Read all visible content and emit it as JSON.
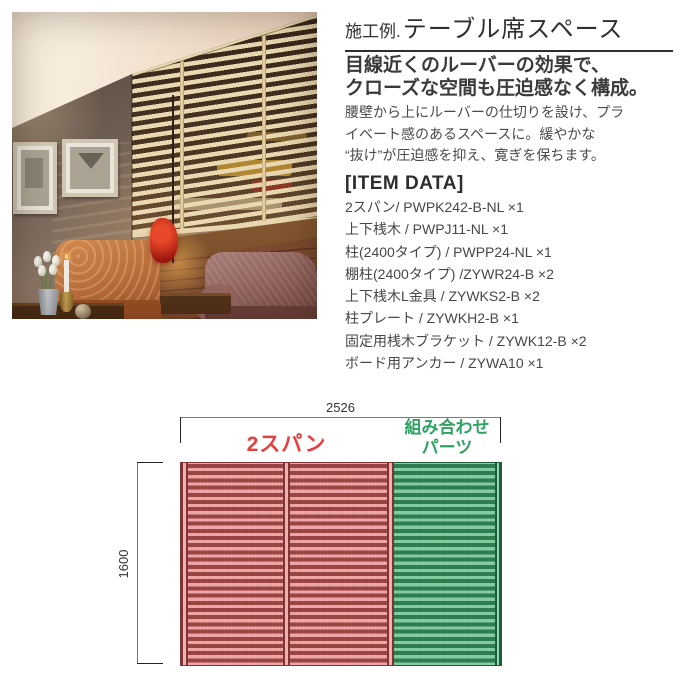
{
  "header": {
    "prefix": "施工例.",
    "title": "テーブル席スペース"
  },
  "lead": {
    "lines": [
      "目線近くのルーバーの効果で、",
      "クローズな空間も圧迫感なく構成。"
    ]
  },
  "body": {
    "lines": [
      "腰壁から上にルーバーの仕切りを設け、プラ",
      "イベート感のあるスペースに。緩やかな",
      "“抜け”が圧迫感を抑え、寛ぎを保ちます。"
    ]
  },
  "item_data": {
    "heading": "[ITEM DATA]",
    "items": [
      "2スパン/ PWPK242-B-NL ×1",
      "上下桟木 / PWPJ11-NL ×1",
      "柱(2400タイプ) / PWPP24-NL ×1",
      "棚柱(2400タイプ) /ZYWR24-B ×2",
      "上下桟木L金具 / ZYWKS2-B ×2",
      "柱プレート / ZYWKH2-B ×1",
      "固定用桟木ブラケット / ZYWK12-B ×2",
      "ボード用アンカー / ZYWA10 ×1"
    ]
  },
  "diagram": {
    "width_label": "2526",
    "height_label": "1600",
    "span_label": "2スパン",
    "parts_label_line1": "組み合わせ",
    "parts_label_line2": "パーツ",
    "colors": {
      "span_accent": "#e2413f",
      "parts_accent": "#2da262",
      "red_bg": "#f2a8a8",
      "red_bar": "#9c4545",
      "green_bg": "#85cfa2",
      "green_bar": "#2e7e52"
    }
  }
}
